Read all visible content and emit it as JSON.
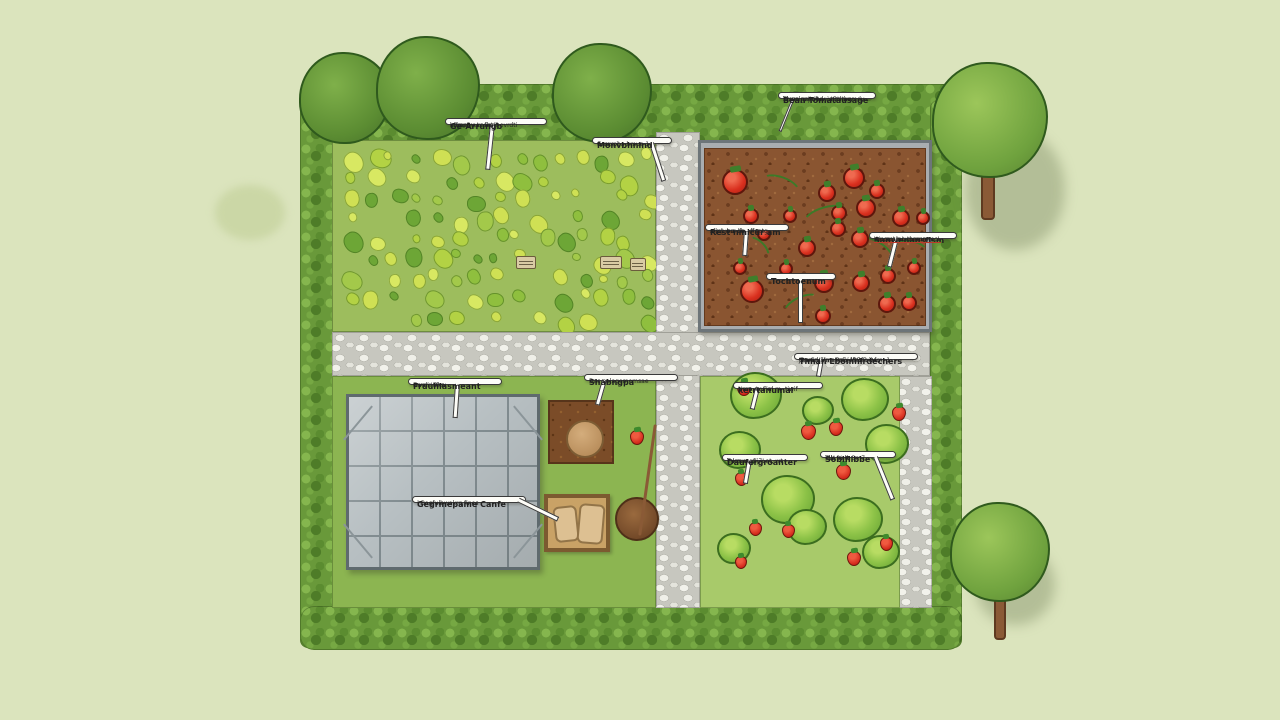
{
  "palette": {
    "background": "#dbe4bd",
    "grass": "#8cb551",
    "veg_bed": "#9dbd5d",
    "strawberry_bed": "#a8ca6a",
    "hedge": "#69993a",
    "gravel": "#c7c7bf",
    "soil": "#8a5531",
    "greenhouse": "#b7bfc2",
    "tomato_red": "#d92f1e",
    "strawberry_red": "#d42a1c",
    "wood": "#c9a266",
    "callout_bg": "#fdfdf8"
  },
  "labels": {
    "veg_main": {
      "l1": "Ge-Arrungb",
      "l2": "affmebu Lasat™",
      "l3": "komnt'yur; flant ovrdti"
    },
    "veg_side": {
      "l1": "Monvbhnlnd",
      "l2": "Gnu; pna hmue 1",
      "l3": "9. me 1"
    },
    "tomato_top": {
      "l1": "Bean Tomatausage",
      "l2": "Tivyo gaamuv j tBtl ww",
      "l3": "smasl ww ibd-va psthamdy",
      "l4": "ld wz n; j'u4"
    },
    "tomato_left": {
      "l1": "Rest nmicūr am",
      "l2": "a jut wu; lla",
      "l3": "sfmj: brr-ch—ffaotg"
    },
    "tomato_right": {
      "l1": "Sanwenansfism",
      "l2": "muce smc-thamn mcL",
      "l3": "Wn ac' h Lunmum"
    },
    "tomato_bottom": {
      "l1": "Tochtoenum"
    },
    "big_right": {
      "l1": "Timan Lbomnlrdechers",
      "l2": "Gmwry-Ymainsaj lftBfB-04",
      "l3": "mamd/5hm PzE; Mataviwlm. 1",
      "l4": "J9 uG~"
    },
    "straw_1": {
      "l1": "ketrtanumal",
      "l2": "wvro munal m- tiwif",
      "l3": "Nma. Ix Fim"
    },
    "straw_2": {
      "l1": "Daufergroanter",
      "l2": "humwngfij7Lat, wt",
      "l3": "T km w"
    },
    "straw_3": {
      "l1": "Sobiflibbe",
      "l2": "ulls % w 3m7",
      "l3": "TW tmll"
    },
    "gh_main": {
      "l1": "Fruuhlasmeant",
      "l2": "Gmdi 'Uhs",
      "l3": "Frvam Rkw"
    },
    "gh_box": {
      "l1": "Gegrmepame Canfe",
      "l2": "| Bagfulbwakrg fines"
    },
    "soil_patch": {
      "l1": "Shabngpa",
      "l2": "Das nalagomemsae"
    }
  },
  "scene": {
    "tomatoes": [
      [
        31,
        34,
        13
      ],
      [
        47,
        68,
        8
      ],
      [
        60,
        86,
        7
      ],
      [
        36,
        120,
        7
      ],
      [
        48,
        143,
        12
      ],
      [
        86,
        68,
        7
      ],
      [
        82,
        121,
        7
      ],
      [
        103,
        100,
        9
      ],
      [
        123,
        45,
        9
      ],
      [
        135,
        65,
        8
      ],
      [
        150,
        30,
        11
      ],
      [
        162,
        60,
        10
      ],
      [
        173,
        43,
        8
      ],
      [
        134,
        81,
        8
      ],
      [
        156,
        91,
        9
      ],
      [
        120,
        135,
        10
      ],
      [
        157,
        135,
        9
      ],
      [
        184,
        128,
        8
      ],
      [
        197,
        70,
        9
      ],
      [
        219,
        70,
        7
      ],
      [
        183,
        156,
        9
      ],
      [
        119,
        168,
        8
      ],
      [
        210,
        120,
        7
      ],
      [
        205,
        155,
        8
      ]
    ],
    "vines": [
      [
        55,
        28,
        42,
        22,
        20
      ],
      [
        98,
        58,
        50,
        26,
        -15
      ],
      [
        148,
        92,
        44,
        22,
        30
      ],
      [
        78,
        148,
        40,
        20,
        -25
      ],
      [
        188,
        92,
        36,
        20,
        10
      ],
      [
        38,
        92,
        30,
        18,
        45
      ]
    ],
    "clumps": [
      [
        56,
        22,
        52
      ],
      [
        40,
        76,
        42
      ],
      [
        88,
        126,
        54
      ],
      [
        165,
        26,
        48
      ],
      [
        187,
        70,
        44
      ],
      [
        158,
        146,
        50
      ],
      [
        107,
        153,
        40
      ],
      [
        181,
        178,
        38
      ],
      [
        34,
        174,
        34
      ],
      [
        118,
        36,
        32
      ]
    ],
    "berries": [
      [
        37,
        5,
        14
      ],
      [
        101,
        48,
        15
      ],
      [
        129,
        45,
        14
      ],
      [
        192,
        30,
        14
      ],
      [
        136,
        88,
        15
      ],
      [
        35,
        96,
        13
      ],
      [
        49,
        146,
        13
      ],
      [
        82,
        148,
        13
      ],
      [
        147,
        175,
        14
      ],
      [
        180,
        161,
        13
      ],
      [
        35,
        180,
        12
      ]
    ],
    "markers": [
      [
        516,
        256,
        20,
        13
      ],
      [
        600,
        256,
        22,
        13
      ],
      [
        630,
        258,
        16,
        13
      ]
    ],
    "veg_colors": [
      "#cfe054",
      "#b3d244",
      "#8fbf3e",
      "#6da636",
      "#d8e862",
      "#a3c94a"
    ]
  }
}
